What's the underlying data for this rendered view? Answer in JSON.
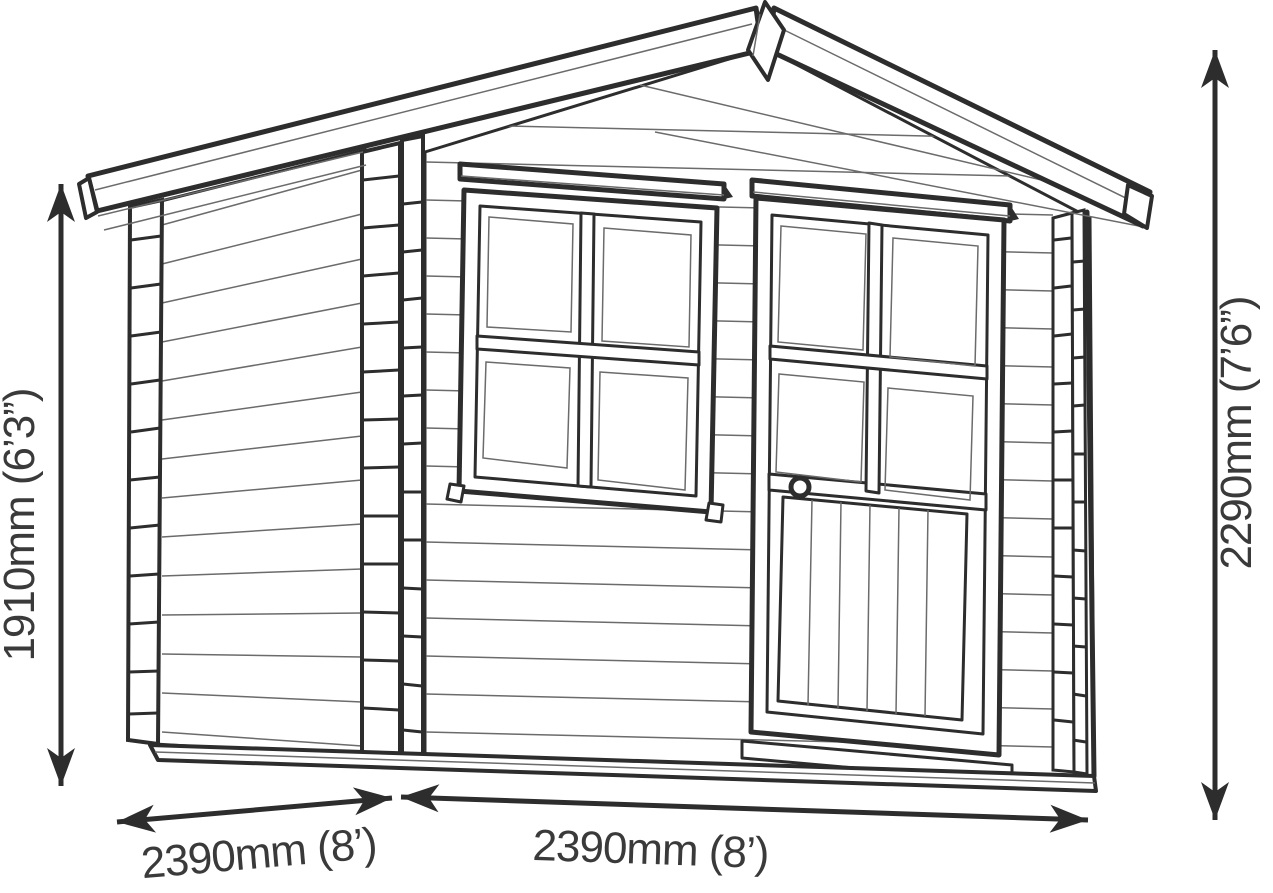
{
  "diagram": {
    "type": "shed-elevation-dimension-drawing",
    "labels": {
      "left_height": "1910mm (6’3”)",
      "right_height": "2290mm (7’6”)",
      "bottom_left_width": "2390mm (8’)",
      "bottom_right_width": "2390mm (8’)"
    },
    "colors": {
      "line": "#2d2d2d",
      "thin_line": "#6b6b6b",
      "text": "#3a3a3a",
      "background": "#ffffff"
    }
  }
}
